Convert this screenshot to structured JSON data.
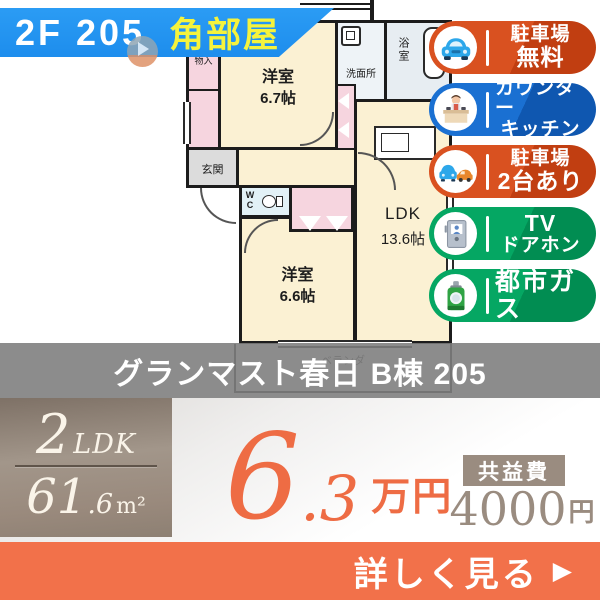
{
  "header": {
    "floor_unit": "2F 205",
    "corner_label": "角部屋"
  },
  "badges": [
    {
      "name": "parking-free",
      "color": "red",
      "lines": [
        "駐車場",
        "無料"
      ]
    },
    {
      "name": "counter-kitchen",
      "color": "blue",
      "lines": [
        "カウンター",
        "キッチン"
      ]
    },
    {
      "name": "parking-2cars",
      "color": "red",
      "lines": [
        "駐車場",
        "2台あり"
      ]
    },
    {
      "name": "tv-doorphone",
      "color": "green",
      "lines": [
        "TV",
        "ドアホン"
      ]
    },
    {
      "name": "city-gas",
      "color": "green",
      "lines": [
        "都市ガス"
      ]
    }
  ],
  "floorplan": {
    "rooms": {
      "monoire": {
        "label": "物入"
      },
      "yoshitsu67": {
        "label": "洋室",
        "size": "6.7帖"
      },
      "senmenjo": {
        "label": "洗面所"
      },
      "yokushitsu": {
        "label": "浴室"
      },
      "genkan": {
        "label": "玄関"
      },
      "wc": {
        "label": "WC"
      },
      "yoshitsu66": {
        "label": "洋室",
        "size": "6.6帖"
      },
      "ldk": {
        "label": "LDK",
        "size": "13.6帖"
      },
      "balcony": {
        "label": "ベランダ"
      }
    }
  },
  "title": "グランマスト春日 B棟 205",
  "spec": {
    "rooms_count": "2",
    "layout_suffix": "LDK",
    "area_int": "61",
    "area_dec": ".6",
    "area_unit": "m²"
  },
  "price": {
    "rent_int": "6",
    "rent_dec": ".3",
    "rent_unit": "万円"
  },
  "fee": {
    "label": "共益費",
    "value": "4000",
    "unit": "円"
  },
  "cta": {
    "label": "詳しく見る",
    "arrow": "▶"
  },
  "colors": {
    "accent_orange": "#ee6c44",
    "band_blue": "#2196f3",
    "badge_red": "#d5491c",
    "badge_blue": "#1668c8",
    "badge_green": "#00a05e",
    "taupe": "#9a8c80",
    "highlight_yellow": "#f5f33d",
    "room_cream": "#fbf1d3",
    "closet_pink": "#f6d5df"
  }
}
